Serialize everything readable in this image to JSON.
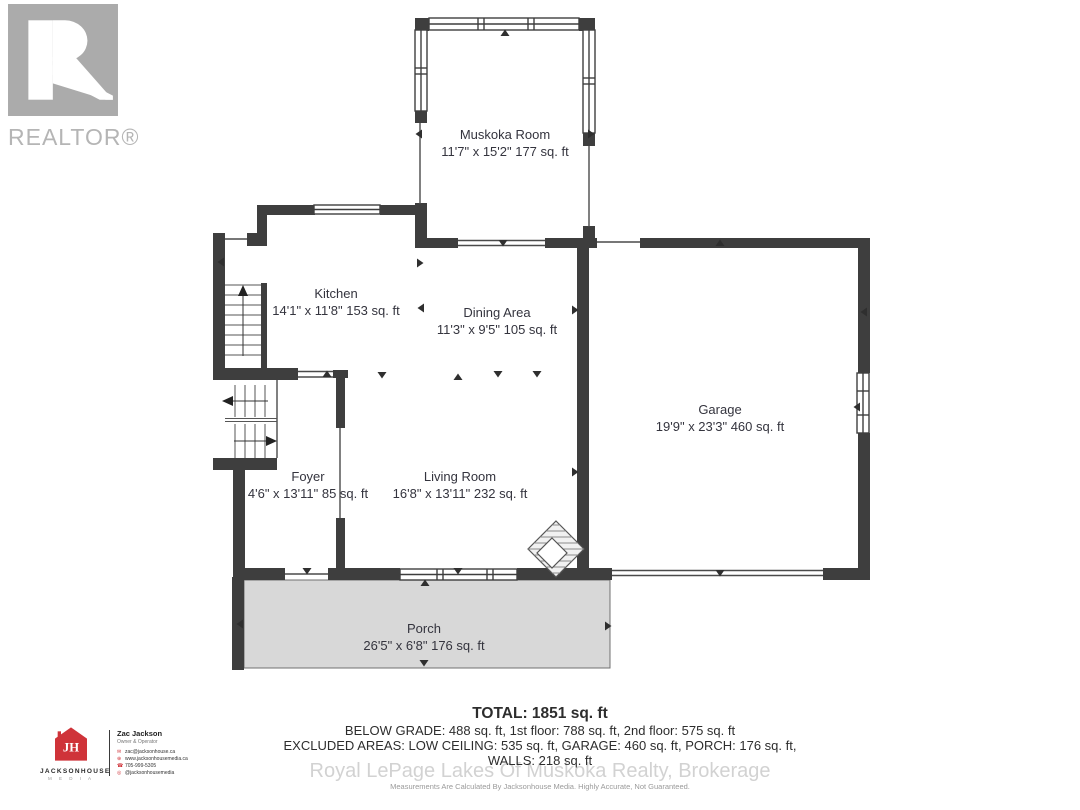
{
  "branding": {
    "realtor_label": "REALTOR®"
  },
  "rooms": {
    "muskoka": {
      "name": "Muskoka Room",
      "dims": "11'7\" x 15'2\" 177 sq. ft"
    },
    "kitchen": {
      "name": "Kitchen",
      "dims": "14'1\" x 11'8\" 153 sq. ft"
    },
    "dining": {
      "name": "Dining Area",
      "dims": "11'3\" x 9'5\" 105 sq. ft"
    },
    "garage": {
      "name": "Garage",
      "dims": "19'9\" x 23'3\" 460 sq. ft"
    },
    "foyer": {
      "name": "Foyer",
      "dims": "4'6\" x 13'11\" 85 sq. ft"
    },
    "living": {
      "name": "Living Room",
      "dims": "16'8\" x 13'11\" 232 sq. ft"
    },
    "porch": {
      "name": "Porch",
      "dims": "26'5\" x 6'8\" 176 sq. ft"
    }
  },
  "summary": {
    "total": "TOTAL: 1851 sq. ft",
    "line_floors": "BELOW GRADE: 488 sq. ft, 1st floor: 788 sq. ft, 2nd floor: 575 sq. ft",
    "line_excluded": "EXCLUDED AREAS: LOW CEILING: 535 sq. ft, GARAGE: 460 sq. ft, PORCH: 176 sq. ft,",
    "line_walls": "WALLS: 218 sq. ft",
    "disclaimer": "Measurements Are Calculated By Jacksonhouse Media. Highly Accurate, Not Guaranteed."
  },
  "watermark": "Royal LePage Lakes Of Muskoka Realty, Brokerage",
  "media_card": {
    "logo_monogram": "JH",
    "company": "JACKSONHOUSE",
    "company_sub": "M E D I A",
    "agent_name": "Zac Jackson",
    "agent_title": "Owner & Operator",
    "email": "zac@jacksonhouse.ca",
    "website": "www.jacksonhousemedia.ca",
    "phone": "705-999-5305",
    "instagram": "@jacksonhousemedia"
  },
  "colors": {
    "wall": "#3e3e3e",
    "porch_fill": "#d8d8d8",
    "accent_red": "#cf3339",
    "watermark_grey": "#d2d2d2",
    "logo_grey": "#ababab"
  }
}
